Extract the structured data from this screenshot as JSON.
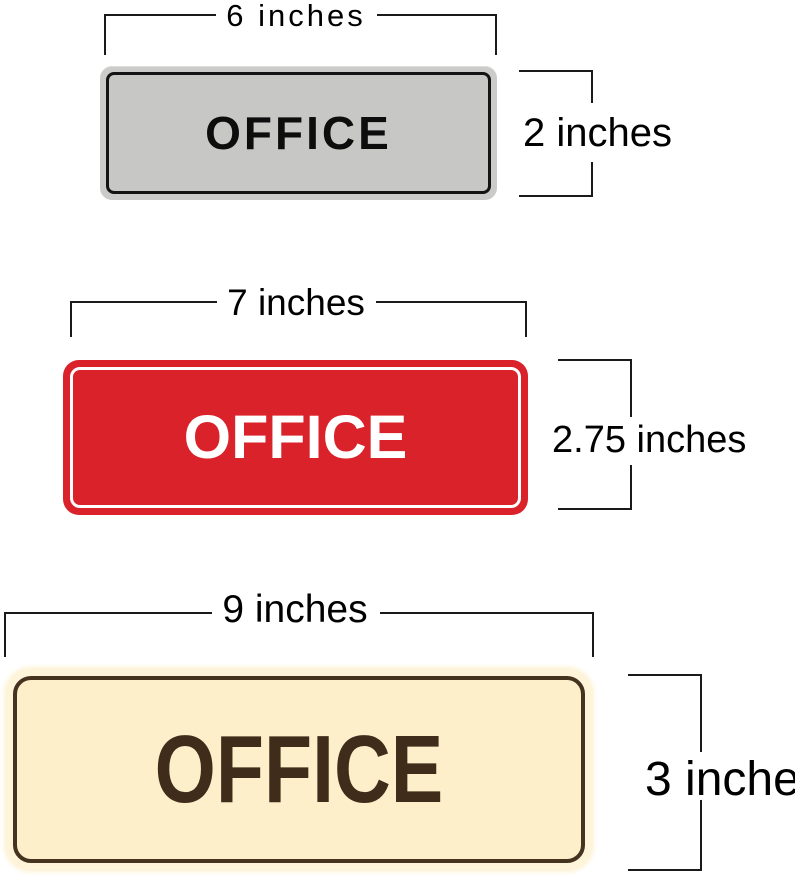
{
  "page": {
    "background": "#ffffff",
    "dimension_line_color": "#1a1a1a"
  },
  "signs": [
    {
      "size_name": "small",
      "text": "OFFICE",
      "width_label": "6 inches",
      "height_label": "2 inches",
      "colors": {
        "plate": "#c7c8c6",
        "rim": "#cbccca",
        "border": "#141414",
        "text": "#0d0d0d"
      }
    },
    {
      "size_name": "medium",
      "text": "OFFICE",
      "width_label": "7 inches",
      "height_label": "2.75 inches",
      "colors": {
        "plate": "#d92229",
        "border": "#ffffff",
        "text": "#ffffff"
      }
    },
    {
      "size_name": "large",
      "text": "OFFICE",
      "width_label": "9 inches",
      "height_label": "3 inches",
      "colors": {
        "glow": "#fdf4da",
        "plate": "#fcefc9",
        "border": "#46331f",
        "text": "#402c1b"
      }
    }
  ]
}
